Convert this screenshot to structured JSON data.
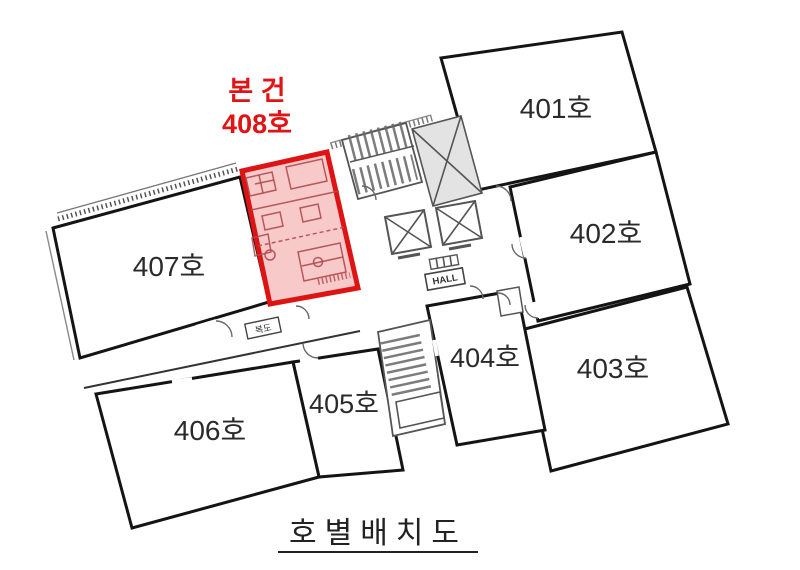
{
  "page": {
    "title": "호별배치도"
  },
  "subject_annotation": {
    "line1": "본 건",
    "line2": "408호"
  },
  "units": [
    {
      "id": "401",
      "label": "401호",
      "highlighted": false
    },
    {
      "id": "402",
      "label": "402호",
      "highlighted": false
    },
    {
      "id": "403",
      "label": "403호",
      "highlighted": false
    },
    {
      "id": "404",
      "label": "404호",
      "highlighted": false
    },
    {
      "id": "405",
      "label": "405호",
      "highlighted": false
    },
    {
      "id": "406",
      "label": "406호",
      "highlighted": false
    },
    {
      "id": "407",
      "label": "407호",
      "highlighted": false
    },
    {
      "id": "408",
      "label": "408호",
      "highlighted": true
    }
  ],
  "core": {
    "hall_label": "HALL",
    "corridor_label": "복도"
  },
  "colors": {
    "wall": "#141414",
    "highlight_border": "#de1414",
    "highlight_fill": "#f7c9c9",
    "annotation_red": "#e01414",
    "detail_gray": "#666666",
    "text": "#2a2a2a"
  }
}
